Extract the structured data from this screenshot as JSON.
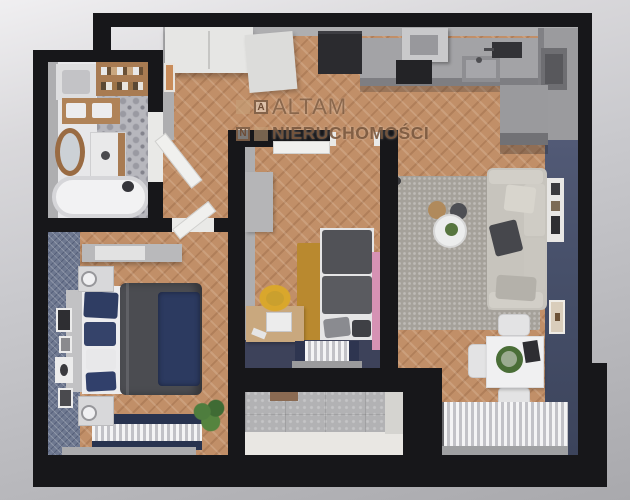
{
  "watermark": {
    "logo_letter_top": "A",
    "logo_letter_bottom": "N",
    "brand_line1": "ALTAM",
    "brand_line2": "NIERUCHOMOŚCI"
  },
  "palette": {
    "wall_black": "#17171a",
    "wood_floor": "#c18f68",
    "navy_accent_wall": "#47506a",
    "navy_textile": "#2e3c62",
    "gray_rug": "#a5a19a",
    "mustard_rug": "#b9892f",
    "pink_panel": "#d692b4",
    "yellow_chair": "#d9a72c",
    "bathroom_tile_gray": "#b7b7bd",
    "watermark_brown": "#7d5a43",
    "background_gray": "#c6c6ca"
  }
}
